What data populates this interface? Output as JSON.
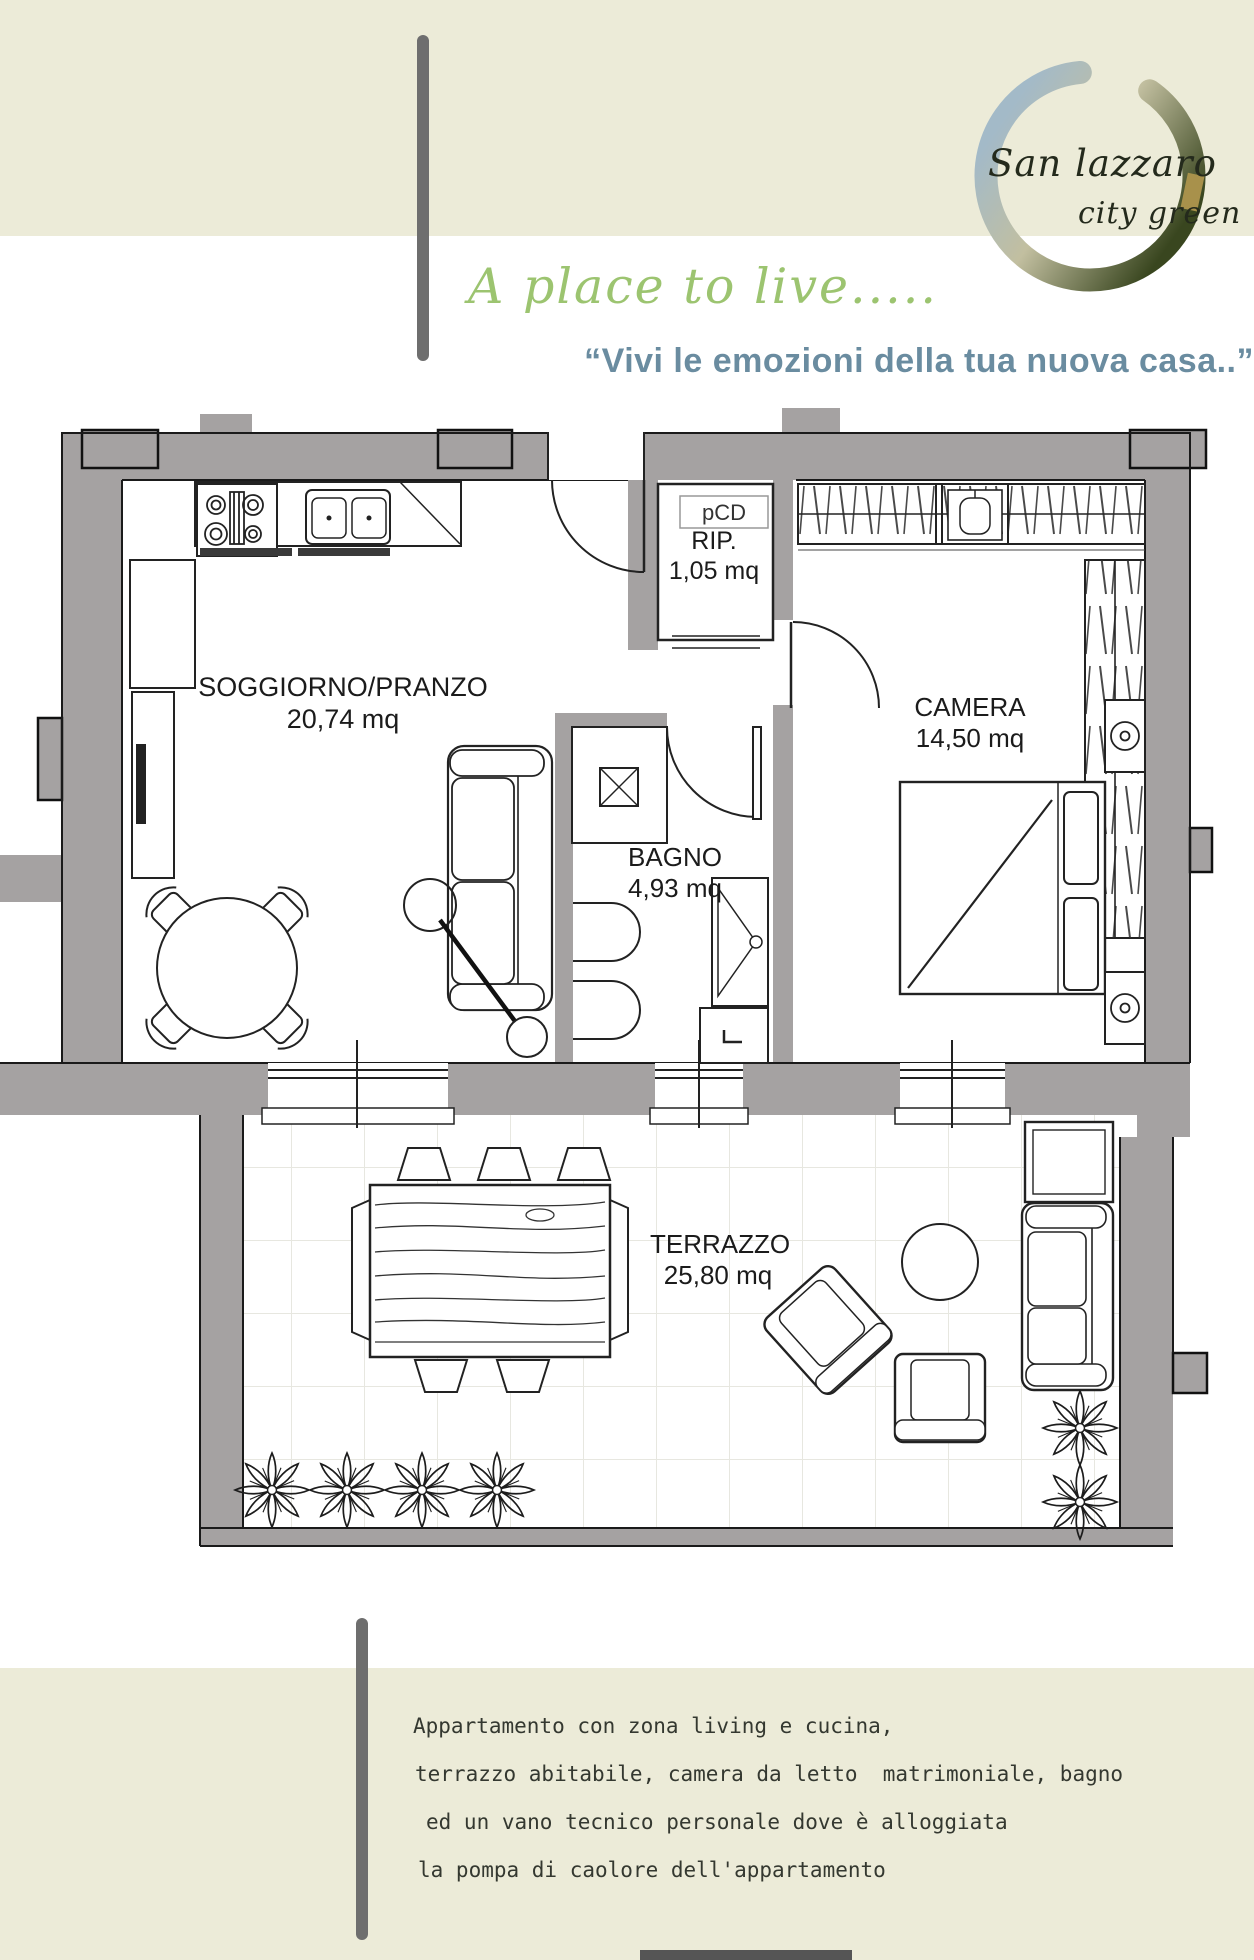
{
  "colors": {
    "band": "#ecebd8",
    "accent_green": "#9cc470",
    "accent_blue": "#6a8ca0",
    "wall_gray": "#a5a2a2",
    "bar_gray": "#6e6e6e"
  },
  "header": {
    "logo": {
      "line1": "San lazzaro",
      "line2": "city green"
    },
    "script_tagline": "A place to live.....",
    "quote": "“Vivi le emozioni della tua nuova casa..”"
  },
  "floorplan": {
    "pcd_label": "pCD",
    "rooms": [
      {
        "name": "SOGGIORNO/PRANZO",
        "area": "20,74 mq"
      },
      {
        "name": "RIP.",
        "area": "1,05 mq"
      },
      {
        "name": "CAMERA",
        "area": "14,50 mq"
      },
      {
        "name": "BAGNO",
        "area": "4,93 mq"
      },
      {
        "name": "TERRAZZO",
        "area": "25,80 mq"
      }
    ]
  },
  "description": {
    "lines": [
      "Appartamento con zona living e cucina,",
      "terrazzo abitabile, camera da letto  matrimoniale, bagno",
      "ed un vano tecnico personale dove è alloggiata",
      "la pompa di caolore dell'appartamento"
    ]
  }
}
